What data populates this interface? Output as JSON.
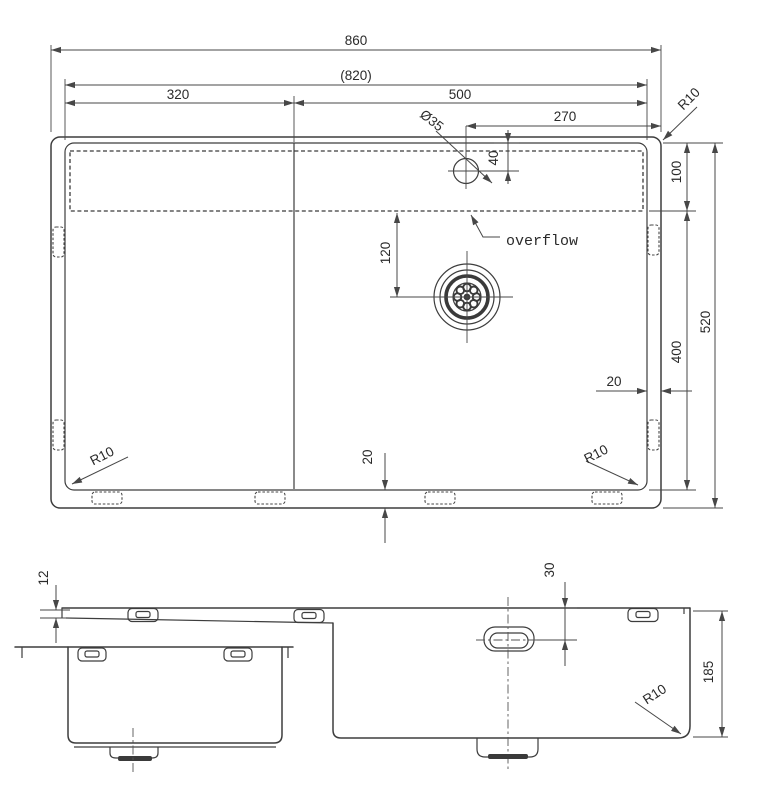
{
  "colors": {
    "line": "#3d3d3d",
    "text": "#2a2a2a",
    "background": "#ffffff"
  },
  "views": {
    "plan": {
      "dims": {
        "overall_width": "860",
        "inner_width": "(820)",
        "left_section_width": "320",
        "bowl_width": "500",
        "drain_offset_from_right": "270",
        "faucet_hole_diameter": "Ø35",
        "faucet_hole_offset": "40",
        "deck_depth": "100",
        "overall_depth": "520",
        "bowl_length": "400",
        "drain_offset_from_deck": "120",
        "rim_gap_right": "20",
        "rim_gap_bottom": "20",
        "corner_radius_top_right": "R10",
        "corner_radius_bottom_left": "R10",
        "corner_radius_bottom_right": "R10"
      },
      "labels": {
        "overflow": "overflow"
      }
    },
    "front": {
      "dims": {
        "rim_height": "12",
        "overflow_offset": "30",
        "bowl_depth": "185",
        "corner_radius": "R10"
      }
    }
  }
}
